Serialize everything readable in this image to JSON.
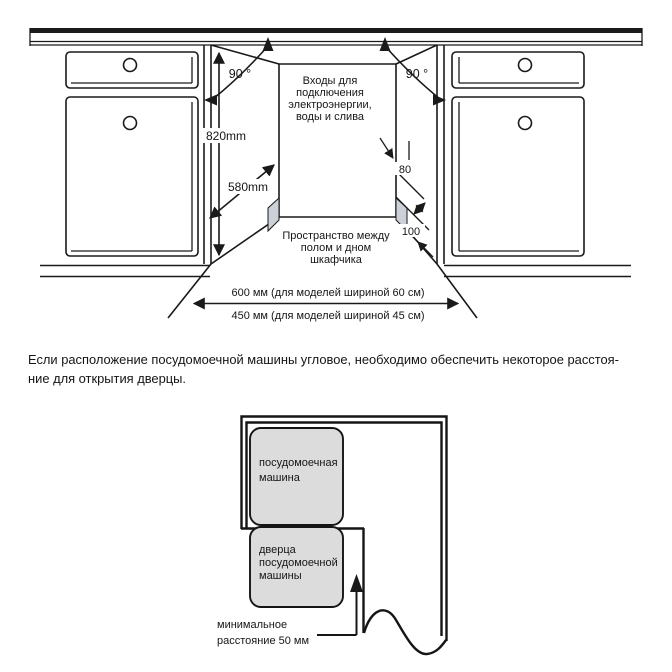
{
  "niche": {
    "angle_left": "90 °",
    "angle_right": "90 °",
    "inlets_l1": "Входы для",
    "inlets_l2": "подключения",
    "inlets_l3": "электроэнергии,",
    "inlets_l4": "воды и слива",
    "dim_height": "820mm",
    "dim_depth": "580mm",
    "dim_80": "80",
    "dim_100": "100",
    "space_l1": "Пространство между",
    "space_l2": "полом и дном",
    "space_l3": "шкафчика",
    "width_600": "600 мм (для моделей шириной 60 см)",
    "width_450": "450 мм (для моделей шириной 45 см)"
  },
  "note": {
    "l1": "Если расположение посудомоечной машины угловое, необходимо обеспечить некоторое расстоя-",
    "l2": "ние для открытия дверцы."
  },
  "corner": {
    "dw_l1": "посудомоечная",
    "dw_l2": "машина",
    "door_l1": "дверца",
    "door_l2": "посудомоечной",
    "door_l3": "машины",
    "min_l1": "минимальное",
    "min_l2": "расстояние  50 мм"
  },
  "colors": {
    "ink": "#1a1a1a",
    "panel_gray": "#dcdcdc",
    "plinth_gray": "#ccd1d7"
  }
}
